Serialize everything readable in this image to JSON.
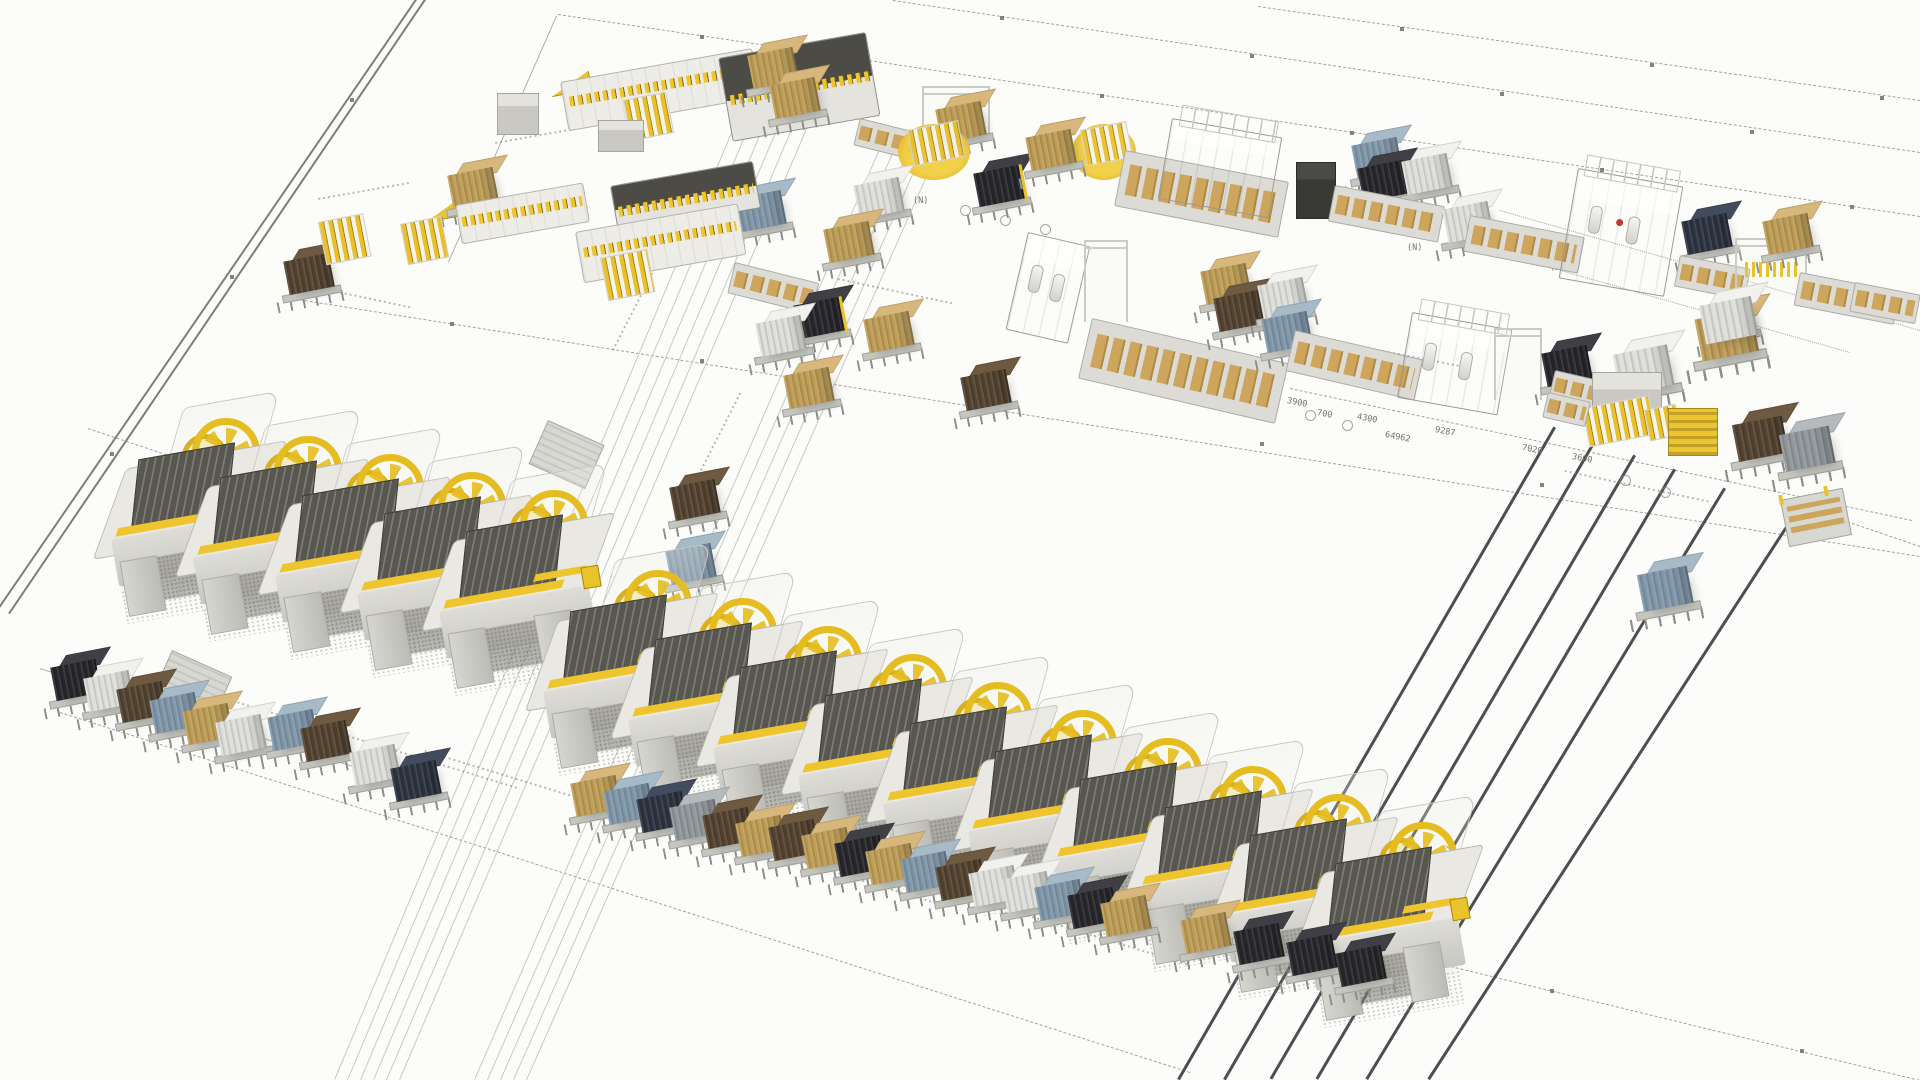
{
  "scene": {
    "w": 1920,
    "h": 1080,
    "background": "#fcfcfa",
    "description": "isometric-3d-factory-layout-render"
  },
  "palette": {
    "accent_yellow": "#eec52c",
    "machine_light": "#e9e8e3",
    "machine_dark": "#57564f",
    "rail": "#4d4e52",
    "line": "#8d8d87",
    "boundary": "#7e7e78"
  },
  "pallet_colors": {
    "black": {
      "f": "#27272b",
      "t": "#3f3f45"
    },
    "white": {
      "f": "#dededa",
      "t": "#f1f1ee"
    },
    "brown": {
      "f": "#53422f",
      "t": "#6e5941"
    },
    "tan": {
      "f": "#bd9c55",
      "t": "#d7b77c"
    },
    "blue": {
      "f": "#7f96a9",
      "t": "#a6bac7"
    },
    "gray": {
      "f": "#90969a",
      "t": "#b5babd"
    },
    "navy": {
      "f": "#2c3340",
      "t": "#434c5c"
    },
    "cream": {
      "f": "#d9d2c4",
      "t": "#eeeae0"
    }
  },
  "lines": [
    [
      417,
      0,
      0,
      608,
      "b"
    ],
    [
      426,
      0,
      10,
      614,
      "b"
    ],
    [
      557,
      16,
      449,
      262,
      "t"
    ],
    [
      558,
      14,
      1920,
      216,
      "d"
    ],
    [
      893,
      0,
      1920,
      152,
      "d"
    ],
    [
      1258,
      6,
      1920,
      100,
      "d"
    ],
    [
      285,
      297,
      1920,
      556,
      "d"
    ],
    [
      88,
      428,
      572,
      590,
      "d"
    ],
    [
      1150,
      893,
      1920,
      1080,
      "d"
    ],
    [
      1290,
      388,
      1912,
      520,
      "d"
    ],
    [
      1838,
      518,
      1920,
      546,
      "d"
    ],
    [
      60,
      712,
      1190,
      1072,
      "d"
    ],
    [
      1500,
      210,
      1920,
      330,
      "dot"
    ],
    [
      1490,
      250,
      1850,
      352,
      "dot"
    ],
    [
      745,
      102,
      335,
      1080,
      "f"
    ],
    [
      758,
      106,
      348,
      1080,
      "f"
    ],
    [
      771,
      110,
      361,
      1080,
      "f"
    ],
    [
      784,
      114,
      374,
      1080,
      "f"
    ],
    [
      797,
      118,
      387,
      1080,
      "f"
    ],
    [
      810,
      122,
      400,
      1080,
      "f"
    ],
    [
      885,
      138,
      475,
      1080,
      "f"
    ],
    [
      898,
      142,
      488,
      1080,
      "f"
    ],
    [
      911,
      146,
      501,
      1080,
      "f"
    ],
    [
      924,
      150,
      514,
      1080,
      "f"
    ],
    [
      937,
      154,
      527,
      1080,
      "f"
    ],
    [
      40,
      668,
      430,
      790,
      "t"
    ]
  ],
  "rails": [
    [
      1556,
      428,
      1180,
      1080
    ],
    [
      1596,
      442,
      1226,
      1080
    ],
    [
      1636,
      456,
      1272,
      1080
    ],
    [
      1676,
      470,
      1318,
      1080
    ],
    [
      1726,
      489,
      1368,
      1080
    ],
    [
      1798,
      512,
      1430,
      1080
    ]
  ],
  "markers": [
    [
      700,
      35
    ],
    [
      840,
      55
    ],
    [
      1100,
      94
    ],
    [
      1350,
      131
    ],
    [
      1600,
      168
    ],
    [
      1850,
      205
    ],
    [
      1000,
      16
    ],
    [
      1250,
      54
    ],
    [
      1500,
      92
    ],
    [
      1750,
      130
    ],
    [
      1400,
      27
    ],
    [
      1650,
      63
    ],
    [
      1880,
      96
    ],
    [
      450,
      322
    ],
    [
      700,
      359
    ],
    [
      980,
      400
    ],
    [
      1260,
      442
    ],
    [
      1540,
      483
    ],
    [
      1820,
      525
    ],
    [
      1300,
      929
    ],
    [
      1550,
      989
    ],
    [
      1800,
      1049
    ],
    [
      350,
      98
    ],
    [
      230,
      275
    ],
    [
      110,
      452
    ]
  ],
  "smudges": [
    [
      495,
      142,
      85,
      -10
    ],
    [
      318,
      198,
      95,
      -10
    ],
    [
      296,
      282,
      120,
      12
    ],
    [
      838,
      278,
      120,
      12
    ],
    [
      1290,
      332,
      180,
      11
    ],
    [
      1565,
      470,
      150,
      12
    ],
    [
      233,
      700,
      300,
      17
    ],
    [
      425,
      750,
      190,
      17
    ],
    [
      700,
      830,
      260,
      17
    ],
    [
      980,
      900,
      220,
      17
    ],
    [
      612,
      350,
      110,
      -63
    ],
    [
      700,
      470,
      90,
      -63
    ]
  ],
  "labels": [
    {
      "t": "3900",
      "x": 1288,
      "y": 396,
      "r": 11
    },
    {
      "t": "700",
      "x": 1318,
      "y": 408,
      "r": 11
    },
    {
      "t": "4300",
      "x": 1358,
      "y": 412,
      "r": 11
    },
    {
      "t": "64962",
      "x": 1386,
      "y": 430,
      "r": 11
    },
    {
      "t": "9287",
      "x": 1436,
      "y": 425,
      "r": 11
    },
    {
      "t": "7020",
      "x": 1523,
      "y": 443,
      "r": 11
    },
    {
      "t": "3600",
      "x": 1573,
      "y": 452,
      "r": 11
    },
    {
      "t": "5950",
      "x": 1452,
      "y": 842,
      "r": 62
    },
    {
      "t": "(N)",
      "x": 913,
      "y": 196,
      "r": 0
    },
    {
      "t": "(N)",
      "x": 1150,
      "y": 193,
      "r": 0
    },
    {
      "t": "(N)",
      "x": 1407,
      "y": 243,
      "r": 0
    },
    {
      "t": "(N)",
      "x": 1550,
      "y": 263,
      "r": 0
    }
  ],
  "circles": [
    [
      960,
      205
    ],
    [
      1000,
      215
    ],
    [
      1040,
      224
    ],
    [
      1125,
      352
    ],
    [
      1160,
      365
    ],
    [
      1196,
      377
    ],
    [
      1232,
      389
    ],
    [
      1268,
      399
    ],
    [
      1305,
      410
    ],
    [
      1342,
      420
    ],
    [
      1620,
      475
    ],
    [
      1660,
      487
    ]
  ],
  "press_rows": [
    {
      "start": [
        108,
        400
      ],
      "step": [
        82,
        18
      ],
      "count": 5
    },
    {
      "start": [
        540,
        552
      ],
      "step": [
        85,
        28
      ],
      "count": 10
    }
  ],
  "objects": [
    {
      "t": "boxS",
      "x": 497,
      "y": 93,
      "w": 40,
      "h": 40
    },
    {
      "t": "tilt",
      "x": 545,
      "y": 66,
      "w": 40,
      "h": 30
    },
    {
      "t": "mlong",
      "x": 560,
      "y": 82,
      "w": 195,
      "h": 50,
      "r": -10,
      "teeth": "mid",
      "body": "light"
    },
    {
      "t": "mlong",
      "x": 718,
      "y": 58,
      "w": 150,
      "h": 85,
      "r": -10,
      "teeth": "top",
      "body": "dark"
    },
    {
      "t": "rack",
      "x": 623,
      "y": 100,
      "w": 42,
      "h": 40
    },
    {
      "t": "boxS",
      "x": 598,
      "y": 120,
      "w": 44,
      "h": 30
    },
    {
      "t": "pallet",
      "x": 750,
      "y": 40,
      "c": "tan"
    },
    {
      "t": "pallet",
      "x": 772,
      "y": 70,
      "c": "tan"
    },
    {
      "t": "pallet",
      "x": 738,
      "y": 183,
      "c": "blue"
    },
    {
      "t": "conv",
      "x": 860,
      "y": 118,
      "w": 60,
      "h": 26,
      "r": 14
    },
    {
      "t": "pallet",
      "x": 286,
      "y": 246,
      "c": "brown"
    },
    {
      "t": "rack",
      "x": 318,
      "y": 222,
      "w": 44,
      "h": 42
    },
    {
      "t": "tilt",
      "x": 418,
      "y": 190,
      "w": 42,
      "h": 32
    },
    {
      "t": "pallet",
      "x": 450,
      "y": 160,
      "c": "tan"
    },
    {
      "t": "rack",
      "x": 400,
      "y": 224,
      "w": 40,
      "h": 40
    },
    {
      "t": "mlong",
      "x": 455,
      "y": 205,
      "w": 130,
      "h": 40,
      "r": -10,
      "teeth": "mid",
      "body": "light"
    },
    {
      "t": "mlong",
      "x": 610,
      "y": 186,
      "w": 145,
      "h": 48,
      "r": -10,
      "teeth": "top",
      "body": "dark"
    },
    {
      "t": "mlong",
      "x": 575,
      "y": 232,
      "w": 165,
      "h": 52,
      "r": -10,
      "teeth": "mid",
      "body": "light"
    },
    {
      "t": "conv",
      "x": 735,
      "y": 262,
      "w": 85,
      "h": 30,
      "r": 14
    },
    {
      "t": "rack",
      "x": 600,
      "y": 258,
      "w": 46,
      "h": 42
    },
    {
      "t": "gantry",
      "x": 922,
      "y": 86,
      "w": 64,
      "h": 52
    },
    {
      "t": "pallet",
      "x": 938,
      "y": 94,
      "c": "tan"
    },
    {
      "t": "ttable",
      "x": 898,
      "y": 124,
      "w": 72,
      "h": 56
    },
    {
      "t": "ttable",
      "x": 1072,
      "y": 124,
      "w": 64,
      "h": 56
    },
    {
      "t": "pallet",
      "x": 976,
      "y": 158,
      "c": "black",
      "post": true
    },
    {
      "t": "pallet",
      "x": 1028,
      "y": 122,
      "c": "tan"
    },
    {
      "t": "pallet",
      "x": 856,
      "y": 170,
      "c": "white"
    },
    {
      "t": "pallet",
      "x": 826,
      "y": 214,
      "c": "tan"
    },
    {
      "t": "conv",
      "x": 1125,
      "y": 150,
      "w": 165,
      "h": 55,
      "r": 11
    },
    {
      "t": "boxM",
      "x": 1172,
      "y": 118,
      "w": 110,
      "h": 80,
      "r": 10,
      "frame": true
    },
    {
      "t": "pallet",
      "x": 1354,
      "y": 130,
      "c": "blue"
    },
    {
      "t": "pallet",
      "x": 1360,
      "y": 153,
      "c": "black"
    },
    {
      "t": "pallet",
      "x": 1404,
      "y": 146,
      "c": "white"
    },
    {
      "t": "boxS",
      "x": 1296,
      "y": 162,
      "w": 38,
      "h": 55,
      "dark": true
    },
    {
      "t": "conv",
      "x": 1335,
      "y": 185,
      "w": 110,
      "h": 35,
      "r": 11
    },
    {
      "t": "pallet",
      "x": 1445,
      "y": 194,
      "c": "white"
    },
    {
      "t": "conv",
      "x": 1470,
      "y": 215,
      "w": 115,
      "h": 35,
      "r": 11
    },
    {
      "t": "boxM",
      "x": 1578,
      "y": 168,
      "w": 105,
      "h": 110,
      "r": 10,
      "frame": true,
      "cyl": true,
      "logo": true
    },
    {
      "t": "pallet",
      "x": 1684,
      "y": 206,
      "c": "navy"
    },
    {
      "t": "conv",
      "x": 1680,
      "y": 255,
      "w": 70,
      "h": 30,
      "r": 11
    },
    {
      "t": "gantry",
      "x": 1735,
      "y": 238,
      "w": 68,
      "h": 58,
      "grip": true
    },
    {
      "t": "pallet",
      "x": 1765,
      "y": 206,
      "c": "tan"
    },
    {
      "t": "pallet",
      "x": 1706,
      "y": 290,
      "c": "tan"
    },
    {
      "t": "conv",
      "x": 1800,
      "y": 272,
      "w": 100,
      "h": 32,
      "r": 11
    },
    {
      "t": "conv",
      "x": 1855,
      "y": 282,
      "w": 65,
      "h": 28,
      "r": 11
    },
    {
      "t": "boxM",
      "x": 1028,
      "y": 232,
      "w": 62,
      "h": 98,
      "r": 13,
      "cyl": true
    },
    {
      "t": "gantry",
      "x": 1084,
      "y": 240,
      "w": 40,
      "h": 80
    },
    {
      "t": "conv",
      "x": 1092,
      "y": 318,
      "w": 200,
      "h": 60,
      "r": 13
    },
    {
      "t": "pallet",
      "x": 1203,
      "y": 256,
      "c": "tan"
    },
    {
      "t": "pallet",
      "x": 1216,
      "y": 283,
      "c": "brown"
    },
    {
      "t": "pallet",
      "x": 1260,
      "y": 270,
      "c": "white"
    },
    {
      "t": "pallet",
      "x": 1264,
      "y": 304,
      "c": "blue"
    },
    {
      "t": "conv",
      "x": 1295,
      "y": 330,
      "w": 130,
      "h": 40,
      "r": 13
    },
    {
      "t": "boxM",
      "x": 1412,
      "y": 312,
      "w": 100,
      "h": 85,
      "r": 10,
      "frame": true,
      "cyl": true
    },
    {
      "t": "gantry",
      "x": 1494,
      "y": 328,
      "w": 44,
      "h": 70
    },
    {
      "t": "pallet",
      "x": 1544,
      "y": 338,
      "c": "black"
    },
    {
      "t": "conv",
      "x": 1555,
      "y": 370,
      "w": 60,
      "h": 26,
      "r": 13
    },
    {
      "t": "pallet",
      "x": 1616,
      "y": 336,
      "c": "white",
      "s": 1.2
    },
    {
      "t": "pallet",
      "x": 1698,
      "y": 300,
      "c": "tan",
      "s": 1.25
    },
    {
      "t": "pallet",
      "x": 1702,
      "y": 288,
      "c": "white",
      "s": 1.15,
      "bare": true
    },
    {
      "t": "boxS",
      "x": 1592,
      "y": 372,
      "w": 68,
      "h": 55
    },
    {
      "t": "rack",
      "x": 1582,
      "y": 408,
      "w": 66,
      "h": 38
    },
    {
      "t": "rack",
      "x": 1644,
      "y": 410,
      "w": 30,
      "h": 30
    },
    {
      "t": "tcar",
      "x": 1668,
      "y": 408,
      "w": 48,
      "h": 46
    },
    {
      "t": "pallet",
      "x": 1735,
      "y": 408,
      "c": "brown",
      "s": 1.1
    },
    {
      "t": "pallet",
      "x": 1782,
      "y": 418,
      "c": "gray",
      "s": 1.1
    },
    {
      "t": "conv",
      "x": 1548,
      "y": 392,
      "w": 42,
      "h": 24,
      "r": 13
    },
    {
      "t": "flatcart",
      "x": 1780,
      "y": 500,
      "w": 62,
      "h": 46
    },
    {
      "t": "pallet",
      "x": 1640,
      "y": 558,
      "c": "blue",
      "s": 1.1
    },
    {
      "t": "pallet",
      "x": 796,
      "y": 290,
      "c": "black",
      "post": true
    },
    {
      "t": "pallet",
      "x": 758,
      "y": 308,
      "c": "white"
    },
    {
      "t": "pallet",
      "x": 786,
      "y": 360,
      "c": "tan"
    },
    {
      "t": "pallet",
      "x": 866,
      "y": 304,
      "c": "tan"
    },
    {
      "t": "pallet",
      "x": 963,
      "y": 362,
      "c": "brown"
    },
    {
      "t": "ramp",
      "x": 548,
      "y": 420,
      "w": 60,
      "h": 46
    },
    {
      "t": "ramp",
      "x": 172,
      "y": 650,
      "w": 64,
      "h": 52
    },
    {
      "t": "pallet",
      "x": 672,
      "y": 472,
      "c": "brown"
    },
    {
      "t": "pallet",
      "x": 668,
      "y": 536,
      "c": "blue"
    }
  ],
  "pallet_rows": [
    [
      [
        53,
        652,
        "black"
      ],
      [
        86,
        663,
        "white"
      ],
      [
        119,
        674,
        "brown"
      ],
      [
        152,
        685,
        "blue"
      ],
      [
        185,
        696,
        "tan"
      ],
      [
        218,
        707,
        "white"
      ],
      [
        270,
        702,
        "blue"
      ],
      [
        303,
        713,
        "brown"
      ],
      [
        352,
        737,
        "white"
      ],
      [
        393,
        753,
        "navy"
      ]
    ],
    [
      [
        573,
        768,
        "tan"
      ],
      [
        606,
        776,
        "blue"
      ],
      [
        639,
        784,
        "navy"
      ],
      [
        672,
        792,
        "gray"
      ],
      [
        705,
        800,
        "brown"
      ],
      [
        738,
        808,
        "tan"
      ],
      [
        771,
        812,
        "brown"
      ],
      [
        804,
        820,
        "tan"
      ],
      [
        837,
        828,
        "black"
      ],
      [
        868,
        836,
        "tan"
      ],
      [
        903,
        844,
        "blue"
      ],
      [
        938,
        852,
        "brown"
      ],
      [
        971,
        858,
        "white"
      ],
      [
        1004,
        864,
        "white"
      ],
      [
        1037,
        872,
        "blue"
      ],
      [
        1070,
        880,
        "black"
      ],
      [
        1103,
        888,
        "tan"
      ]
    ],
    [
      [
        1183,
        905,
        "tan"
      ],
      [
        1236,
        916,
        "black"
      ],
      [
        1289,
        927,
        "black"
      ],
      [
        1338,
        938,
        "black"
      ]
    ]
  ]
}
